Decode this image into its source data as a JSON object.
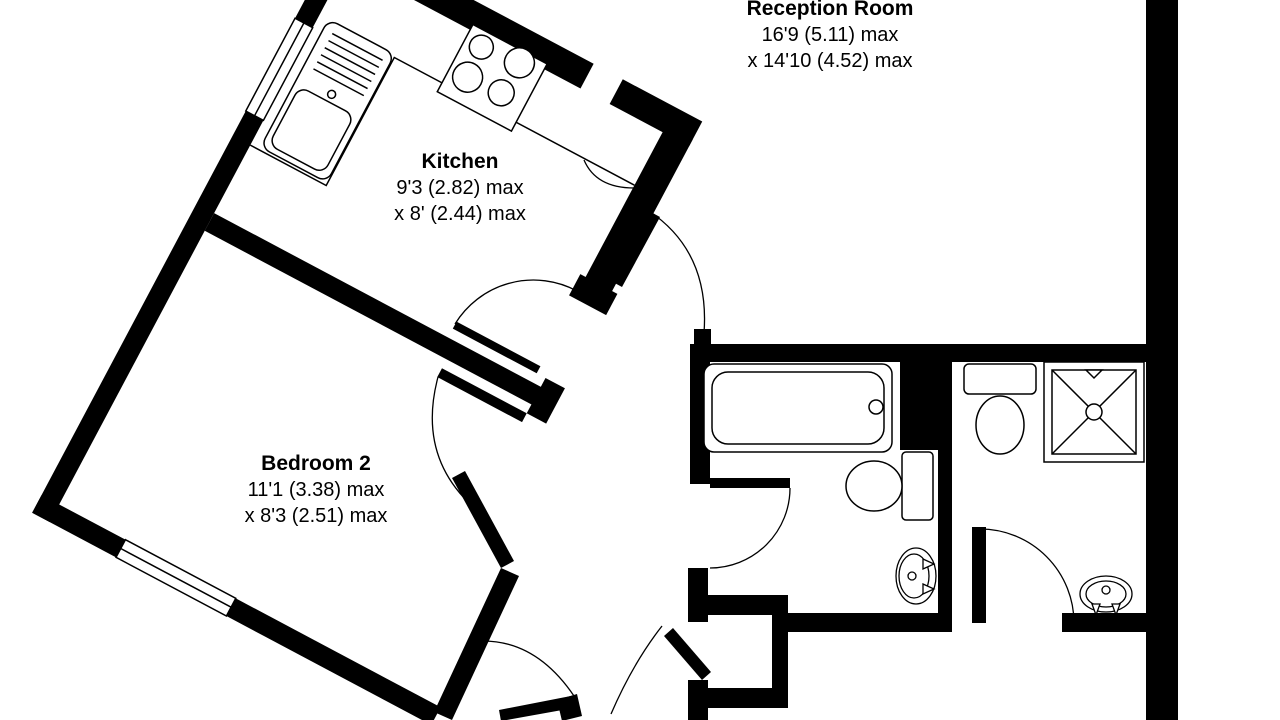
{
  "rooms": [
    {
      "id": "reception-room",
      "name": "Reception Room",
      "dim1": "16'9 (5.11) max",
      "dim2": "x 14'10 (4.52) max"
    },
    {
      "id": "kitchen",
      "name": "Kitchen",
      "dim1": "9'3 (2.82) max",
      "dim2": "x 8' (2.44) max"
    },
    {
      "id": "bedroom-2",
      "name": "Bedroom 2",
      "dim1": "11'1 (3.38) max",
      "dim2": "x 8'3 (2.51) max"
    }
  ],
  "fixtures": {
    "kitchen": [
      "sink-with-drainer",
      "hob-4-burners",
      "counter",
      "window",
      "door-arc"
    ],
    "bedroom_2": [
      "window",
      "door-arc"
    ],
    "bathroom_1": [
      "bathtub",
      "toilet",
      "wash-basin",
      "door-arc"
    ],
    "shower_room": [
      "toilet",
      "shower-tray",
      "wash-basin",
      "door-arc"
    ],
    "hallway": [
      "closet",
      "door-arcs"
    ]
  },
  "colors": {
    "wall": "#000000",
    "background": "#ffffff",
    "line": "#000000"
  }
}
